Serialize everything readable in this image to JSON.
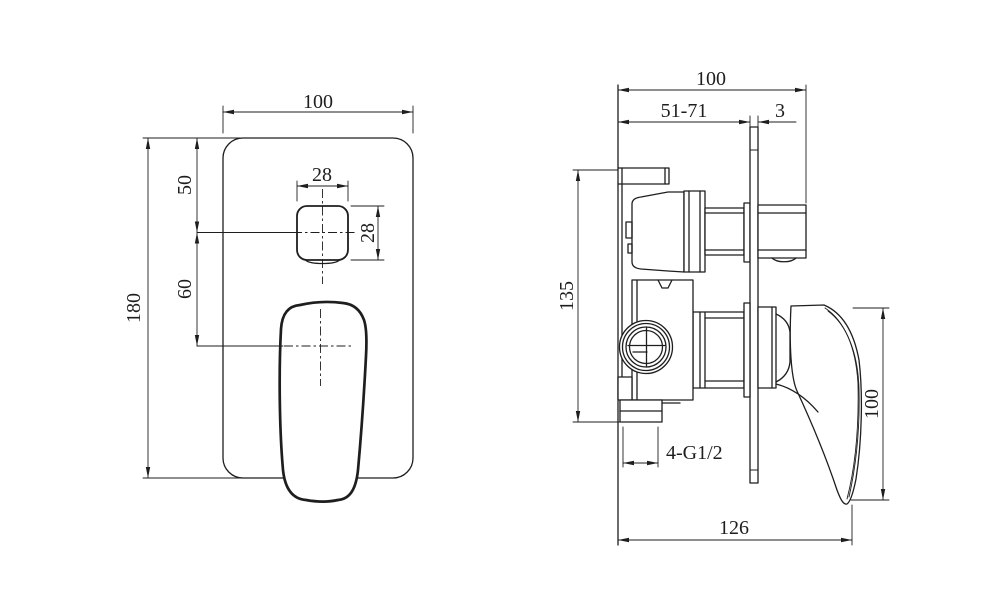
{
  "page": {
    "background": "#ffffff",
    "line_color": "#1e1e1e",
    "description": "Technical dimension drawing of a concealed shower mixer: front view of wall plate with diverter button and lever handle, side view of valve body through wall plate"
  },
  "front_view": {
    "label": "front view",
    "dims": {
      "plate_width": "100",
      "plate_height": "180",
      "button_offset_top": "50",
      "handle_offset": "60",
      "button_width": "28",
      "button_height": "28"
    }
  },
  "side_view": {
    "label": "side view",
    "dims": {
      "depth_total": "100",
      "depth_embed": "51-71",
      "plate_thickness": "3",
      "body_height": "135",
      "handle_height": "100",
      "inlet_thread": "4-G1/2",
      "depth_overall": "126"
    }
  }
}
